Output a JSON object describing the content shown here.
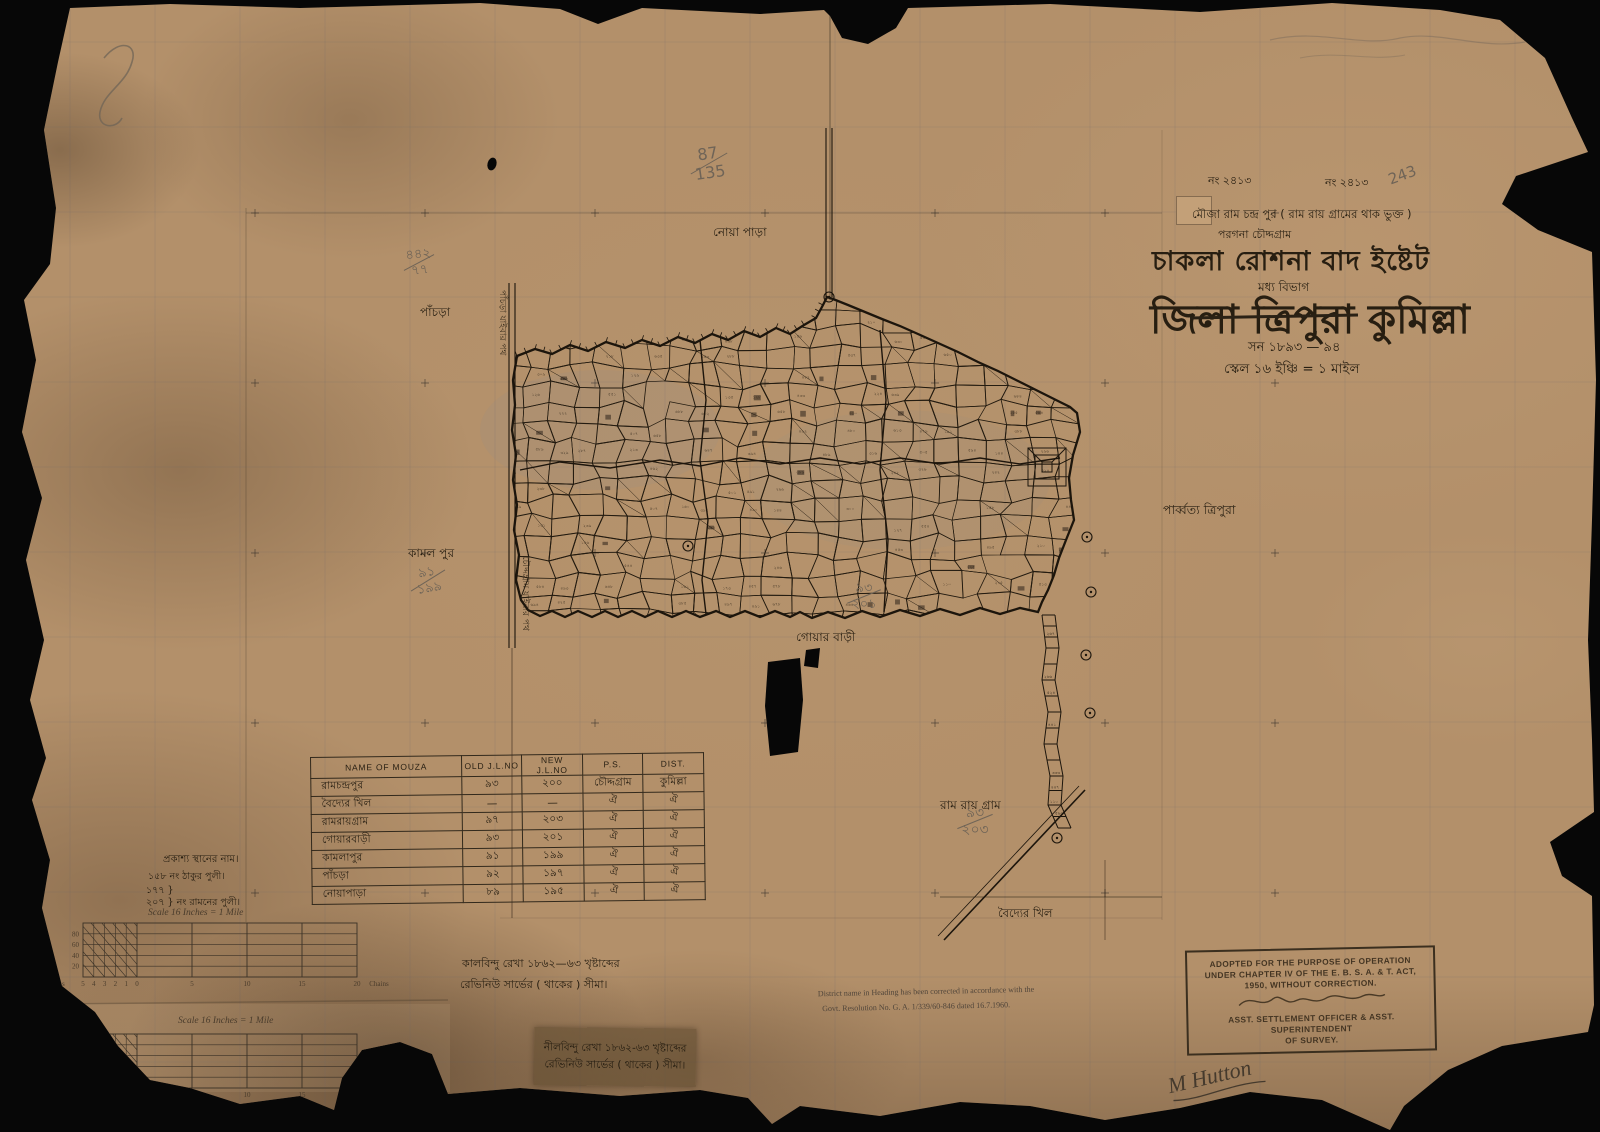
{
  "colors": {
    "paper": "#b3906a",
    "ink": "#261d10",
    "pencil": "#6f6457",
    "stamp_ink": "#3f3322",
    "grid": "#56606f"
  },
  "header": {
    "no_left": "নং ২৪১৩",
    "no_right": "নং ২৪১৩",
    "mouza_line": "মৌজা রাম চন্দ্র পুর ( রাম রায় গ্রামের থাক ভুক্ত )",
    "pargana_line": "পরগনা চৌদ্দগ্রাম",
    "estate_title": "চাকলা রোশনা বাদ ইষ্টেট",
    "division": "মধ্য বিভাগ",
    "district_prefix": "জিলা",
    "district_struck": "ত্রিপুরা",
    "district_current": "কুমিল্লা",
    "year_line": "সন ১৮৯৩ — ৯৪",
    "scale_line": "স্কেল ১৬ ইঞ্চি = ১ মাইল"
  },
  "map_labels": {
    "noapara": "নোয়া পাড়া",
    "pachra": "পাঁচড়া",
    "west_road": "পাঁচড়া যাইবার পথ",
    "south_road": "চৌদ্দগ্রাম যাইবার পথ",
    "kamalpur": "কামল পুর",
    "goarbari": "গোয়ার বাড়ী",
    "parbatya_tripura": "পার্ব্বত্য ত্রিপুরা",
    "ramraygram": "রাম রায় গ্রাম",
    "baidyer_khil": "বৈদ্যের খিল"
  },
  "pencil": {
    "no243": "243",
    "frac_87_135": {
      "top": "87",
      "bottom": "135"
    },
    "frac_442": {
      "top": "৪৪২",
      "bottom": "৭৭"
    },
    "frac_kamalpur": {
      "top": "৯১",
      "bottom": "১৯৯"
    },
    "frac_goarbari": {
      "top": "৯৩",
      "bottom": "২০১"
    },
    "frac_ramraygram": {
      "top": "৯৩",
      "bottom": "২০৩"
    },
    "surveyor_signature": "M Hutton"
  },
  "table": {
    "headers": [
      "NAME OF MOUZA",
      "OLD J.L.NO",
      "NEW J.L.NO",
      "P.S.",
      "DIST."
    ],
    "rows": [
      [
        "রামচন্দ্রপুর",
        "৯৩",
        "২০০",
        "চৌদ্দগ্রাম",
        "কুমিল্লা"
      ],
      [
        "বৈদ্যের খিল",
        "—",
        "—",
        "ঐ",
        "ঐ"
      ],
      [
        "রামরায়গ্রাম",
        "৯৭",
        "২০৩",
        "ঐ",
        "ঐ"
      ],
      [
        "গোয়ারবাড়ী",
        "৯৩",
        "২০১",
        "ঐ",
        "ঐ"
      ],
      [
        "কামলাপুর",
        "৯১",
        "১৯৯",
        "ঐ",
        "ঐ"
      ],
      [
        "পাঁচড়া",
        "৯২",
        "১৯৭",
        "ঐ",
        "ঐ"
      ],
      [
        "নোয়াপাড়া",
        "৮৯",
        "১৯৫",
        "ঐ",
        "ঐ"
      ]
    ]
  },
  "public_places": {
    "title": "প্রকাশ্য স্থানের নাম।",
    "items": [
      "১৫৮ নং ঠাকুর পুলী।",
      "১৭৭ }",
      "২০৭ }  নং রামনের পুলী।"
    ]
  },
  "scale_bars": {
    "title": "Scale 16 Inches = 1 Mile",
    "y_labels": [
      "80",
      "60",
      "40",
      "20"
    ],
    "left_chain_labels": [
      "5",
      "4",
      "3",
      "2",
      "1",
      "0"
    ],
    "right_chain_labels": [
      "5",
      "10",
      "15",
      "20"
    ],
    "unit_left": "Chains",
    "unit_right": "Chains"
  },
  "notes": {
    "black_dot_line1": "কালবিন্দু রেখা ১৮৬২—৬৩ খৃষ্টাব্দের",
    "black_dot_line2": "রেভিনিউ সার্ভের ( থাকের ) সীমা।",
    "blue_dot_line1": "নীলবিন্দু রেখা ১৮৬২-৬৩ খৃষ্টাব্দের",
    "blue_dot_line2": "রেভিনিউ সার্ভের ( থাকের ) সীমা।",
    "district_correction_line1": "District name in Heading has been corrected in accordance with the",
    "district_correction_line2": "Govt. Resolution No. G. A. 1/339/60-846 dated 16.7.1960."
  },
  "stamp": {
    "line1": "ADOPTED FOR THE PURPOSE OF OPERATION",
    "line2": "UNDER CHAPTER IV OF THE E. B. S. A. & T. ACT,",
    "line3": "1950, WITHOUT CORRECTION.",
    "footer1": "ASST. SETTLEMENT OFFICER & ASST. SUPERINTENDENT",
    "footer2": "OF SURVEY."
  }
}
